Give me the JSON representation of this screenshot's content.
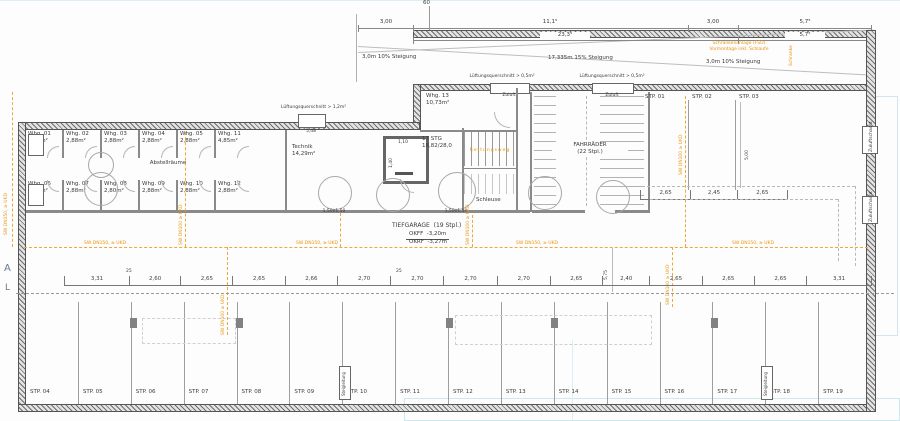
{
  "title": {
    "garage": "TIEFGARAGE  (19 Stpl.)",
    "okff": "OKFF  -3,20m",
    "okrf": "OKRF  -3,27m"
  },
  "storage": {
    "corridor": "Abstellräume",
    "top": [
      {
        "n": "Whg. 01",
        "a": "2,88m²"
      },
      {
        "n": "Whg. 02",
        "a": "2,88m²"
      },
      {
        "n": "Whg. 03",
        "a": "2,88m²"
      },
      {
        "n": "Whg. 04",
        "a": "2,88m²"
      },
      {
        "n": "Whg. 05",
        "a": "2,88m²"
      },
      {
        "n": "Whg. 11",
        "a": "4,85m²"
      }
    ],
    "bottom": [
      {
        "n": "Whg. 06",
        "a": "2,80m²"
      },
      {
        "n": "Whg. 07",
        "a": "2,88m²"
      },
      {
        "n": "Whg. 08",
        "a": "2,80m²"
      },
      {
        "n": "Whg. 09",
        "a": "2,88m²"
      },
      {
        "n": "Whg. 10",
        "a": "2,88m²"
      },
      {
        "n": "Whg. 12",
        "a": "2,88m²"
      }
    ]
  },
  "rooms": {
    "technik_name": "Technik",
    "technik_area": "14,29m²",
    "whg13_name": "Whg. 13",
    "whg13_area": "10,73m²",
    "schleuse": "Schleuse",
    "fahrraeder": "FAHRRÄDER\n(22 Stpl.)",
    "stairs": "17 STG\n18,82/28,0",
    "rettungsweg": "Rettungsweg"
  },
  "ramp": {
    "dim_3a": "3,00",
    "dim_11": "11,1⁵",
    "dim_3b": "3,00",
    "dim_57a": "5,7⁵",
    "dim_23": "23,3⁵",
    "dim_57b": "5,7⁵",
    "dim_60": "60",
    "slope_a": "3,0m 10% Steigung",
    "slope_b": "17,335m 15% Steigung",
    "slope_c": "3,0m 10% Steigung",
    "schranke1": "Schrankenanlage (FSO)",
    "schranke2": "Vormontage inkl. Schlaufe",
    "schranke_v": "Schranke"
  },
  "vents": {
    "quer05": "Lüftungsquerschnitt > 0,5m²",
    "quer12": "Lüftungsquerschnitt > 1,2m²",
    "zuluft": "Zuluft",
    "dim548": "5,48",
    "schacht": "Zuluftschacht"
  },
  "parking": {
    "top": [
      "STP. 01",
      "STP. 02",
      "STP. 03"
    ],
    "top_dims": [
      "2,65",
      "2,45",
      "2,65"
    ],
    "top_vdim": "5,00",
    "bottom": [
      "STP. 04",
      "STP. 05",
      "STP. 06",
      "STP. 07",
      "STP. 08",
      "STP. 09",
      "STP. 10",
      "STP. 11",
      "STP. 12",
      "STP. 13",
      "STP. 14",
      "STP. 15",
      "STP. 16",
      "STP. 17",
      "STP. 18",
      "STP. 19"
    ]
  },
  "dims": {
    "chain": [
      "3,31",
      "2,60",
      "2,65",
      "2,65",
      "2,66",
      "2,70",
      "2,70",
      "2,70",
      "2,70",
      "2,65",
      "2,40",
      "2,65",
      "2,65",
      "2,65",
      "3,31"
    ],
    "p25a": "25",
    "p25b": "25",
    "v575": "5,75",
    "elev_w": "1,10",
    "elev_d": "1,40",
    "circle": "1,50x1,50"
  },
  "utils": {
    "sw150": "SW DN150, ≥ UKD",
    "sw100": "SW DN100 ≥ UKD",
    "riser": "Steigleitung"
  },
  "markers": {
    "a": "A",
    "l": "L"
  }
}
